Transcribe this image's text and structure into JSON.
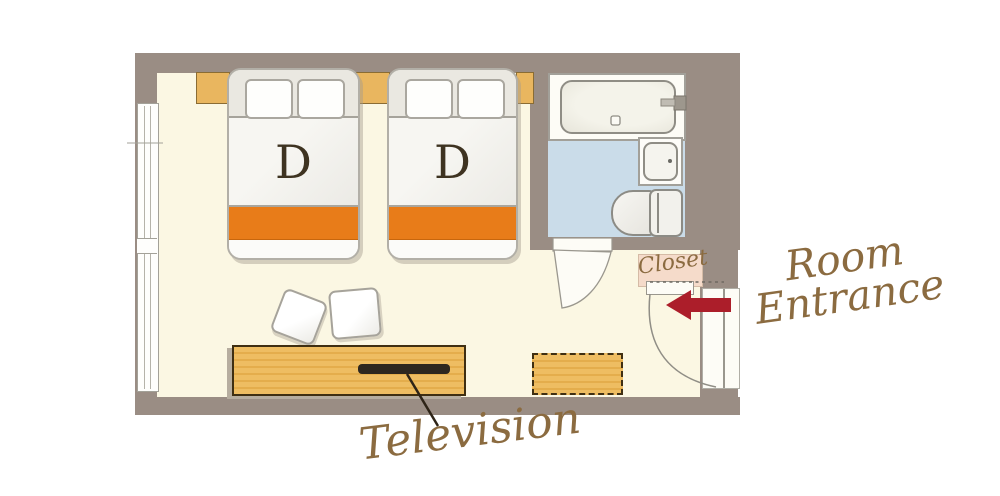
{
  "floorplan": {
    "beds": [
      {
        "label": "D"
      },
      {
        "label": "D"
      }
    ],
    "closet": {
      "label": "Closet"
    },
    "entrance": {
      "line1": "Room",
      "line2": "Entrance",
      "arrow_icon": "left-arrow"
    },
    "television": {
      "label": "Television"
    },
    "fixtures": [
      "bathtub",
      "sink",
      "toilet",
      "window",
      "entrance-door",
      "bathroom-door",
      "tv-console",
      "bench",
      "stool",
      "stool"
    ],
    "colors": {
      "wall": "#9a8d84",
      "room_floor": "#fbf7e3",
      "bathroom_floor": "#cadce9",
      "wood": "#e9b65f",
      "bed_runner_orange": "#e87c19",
      "entrance_arrow_red": "#ac1e2a",
      "label_brown": "#8b6b40"
    }
  }
}
